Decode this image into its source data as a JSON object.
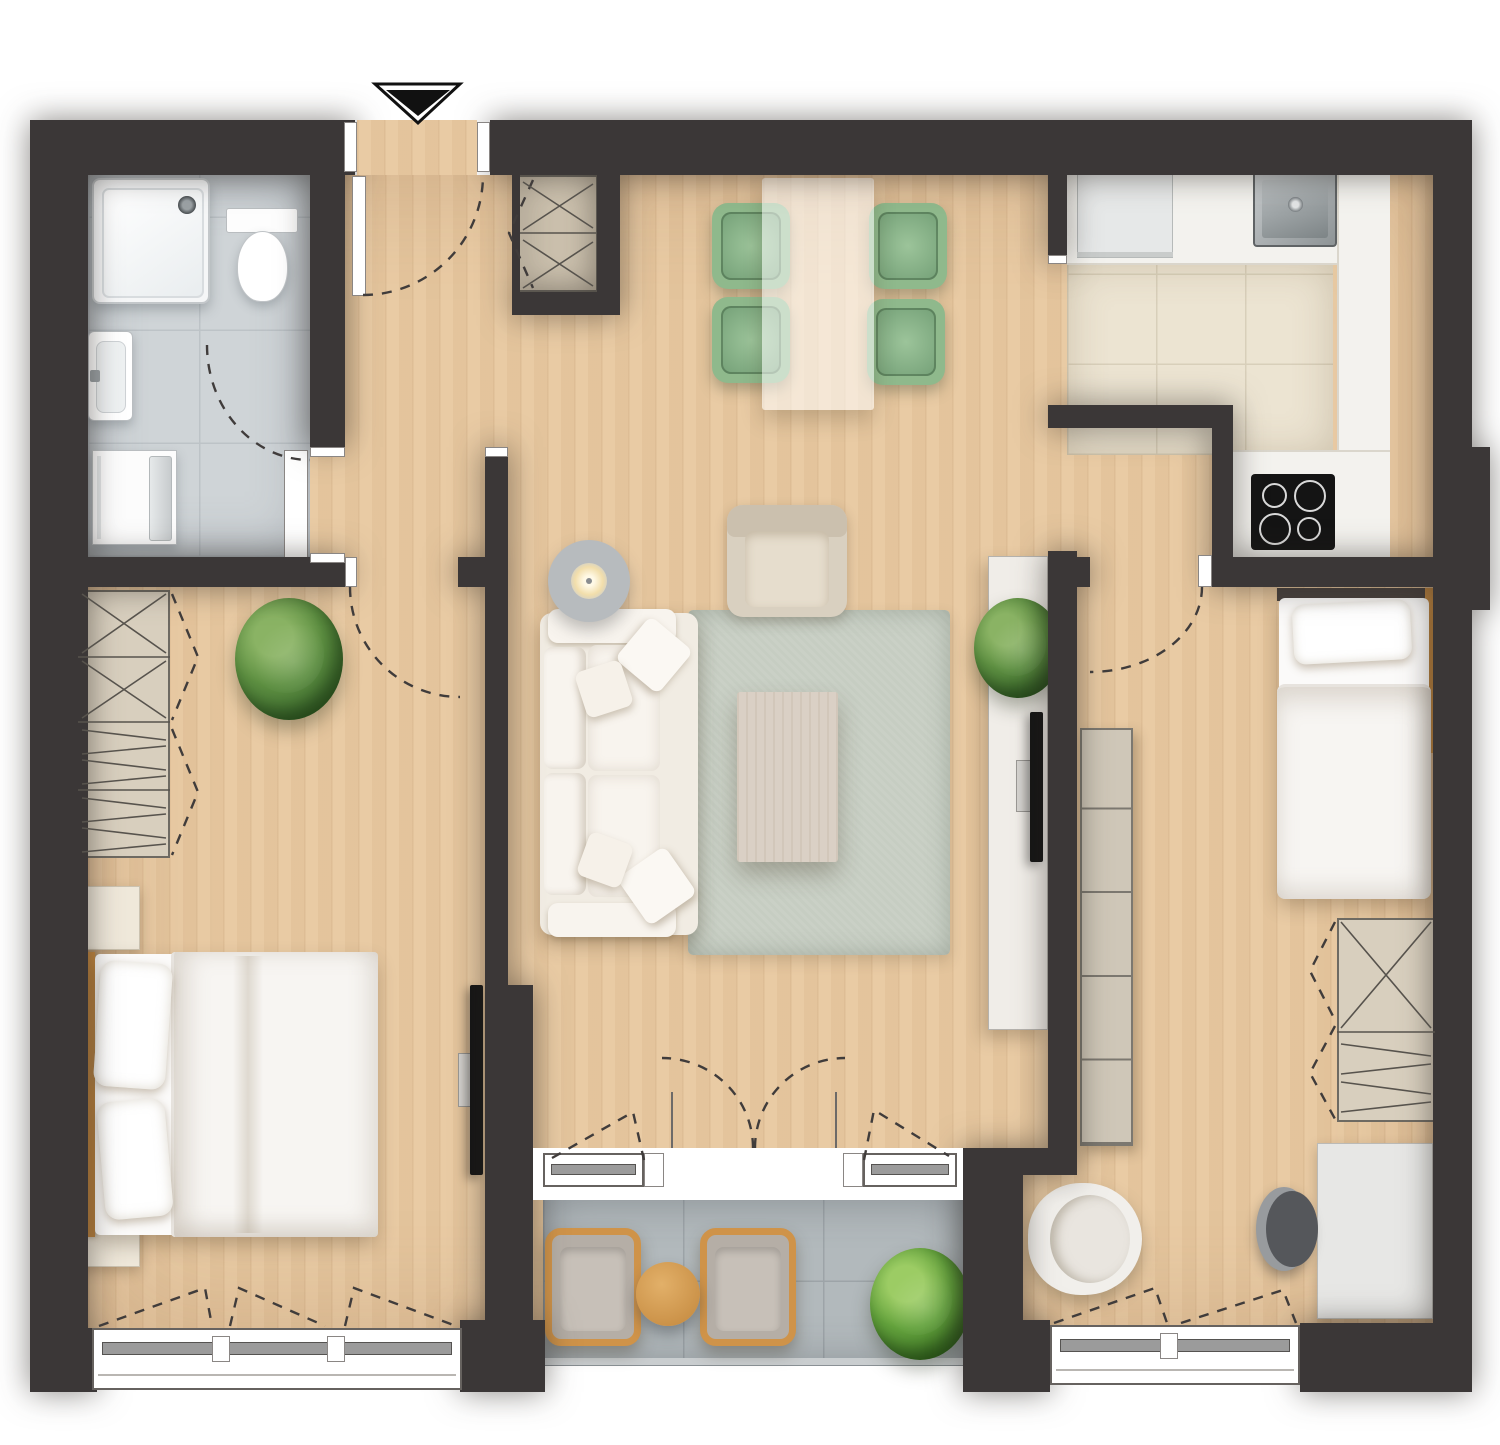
{
  "title": "apartment-floor-plan-top-view",
  "palette": {
    "page": "#ffffff",
    "wall": "#3b3737",
    "wood": "#e8c89f",
    "bathTile": "#cfd4d7",
    "bathLine": "#bdc3c7",
    "kitchenTile": "#ece4d2",
    "kitchenLine": "#d8cfba",
    "balconyTile": "#b2b9bc",
    "balconyLine": "#9da4a8",
    "white": "#ffffff",
    "lineSoft": "#8a8684",
    "glass": "#9b9b9b",
    "rug": "#c6cdc2",
    "sofa": "#f1ece3",
    "cushion": "#f8f4ee",
    "beige": "#d9d0c0",
    "beigeDark": "#cbc0ae",
    "green": "#8fb98c",
    "greenDark": "#74a077",
    "greenIn": "#9cc49a",
    "tableGlass": "rgba(255,255,255,0.55)",
    "woodAccent": "#cf9349",
    "tableWood": "#dcab63",
    "plantHi": "#8ab364",
    "plantMid": "#5d8f41",
    "plantDk": "#3c6a2e",
    "plantBrightHi": "#9ccc64",
    "plantBrightMid": "#63a23c",
    "plantBrightDk": "#3f7727",
    "tvBlack": "#151515",
    "shelf": "#cfc7b8",
    "wardrobeFill": "#d8cfbe",
    "closetFill": "#cbc0ad",
    "grayChair": "#55575b",
    "grayChairLight": "#989b9e",
    "lamp": "#b7bbbe",
    "counter": "#f3f2ee",
    "steel": "#aeb4b7",
    "hob": "#141414",
    "dash": "#403c3b",
    "patternLine": "#57534d",
    "nightstand": "#efe8da",
    "desk": "#e7e7e5",
    "sideboard": "#f0ede8",
    "duvet": "#f7f5f2",
    "mattress": "#fbfaf9",
    "rail": "#c9cdcf",
    "headboard": "#c68a42",
    "wickerPad": "#b5aea6",
    "wickerSeat": "#c7c0b8"
  },
  "plan": {
    "entry": {
      "marker": "down-arrow",
      "location": "top-center-left"
    },
    "rooms": [
      {
        "id": "bathroom",
        "position": "top-left",
        "floor": "gray-tile",
        "fixtures": [
          "shower",
          "toilet",
          "wash-basin",
          "washing-machine"
        ],
        "door": "swing-in-from-hall"
      },
      {
        "id": "hallway",
        "position": "center-left-spine",
        "floor": "wood",
        "fixtures": [
          "entry-closet-with-hangers"
        ]
      },
      {
        "id": "living-dining-room",
        "position": "center",
        "floor": "wood",
        "fixtures": [
          "dining-table",
          "4-green-chairs",
          "sofa",
          "floor-lamp",
          "rug",
          "coffee-table",
          "armchair",
          "sideboard",
          "plant",
          "tv"
        ],
        "openings": [
          "french-door-to-balcony",
          "2-windows"
        ]
      },
      {
        "id": "kitchen",
        "position": "top-right",
        "floor": "beige-tile",
        "fixtures": [
          "fridge",
          "counter-L",
          "steel-sink",
          "induction-hob"
        ]
      },
      {
        "id": "bedroom-1",
        "position": "left",
        "floor": "wood",
        "fixtures": [
          "wardrobe-4-sections",
          "plant",
          "2-nightstands",
          "double-bed",
          "wall-tv"
        ],
        "openings": [
          "3-section-window"
        ]
      },
      {
        "id": "bedroom-2",
        "position": "right",
        "floor": "wood",
        "fixtures": [
          "single-bed",
          "cube-shelf",
          "wardrobe-2-sections",
          "desk",
          "desk-chair",
          "armchair"
        ],
        "openings": [
          "2-section-window"
        ]
      },
      {
        "id": "balcony",
        "position": "bottom-center",
        "floor": "gray-tile",
        "fixtures": [
          "2-wicker-chairs",
          "round-side-table",
          "plant"
        ]
      }
    ]
  }
}
